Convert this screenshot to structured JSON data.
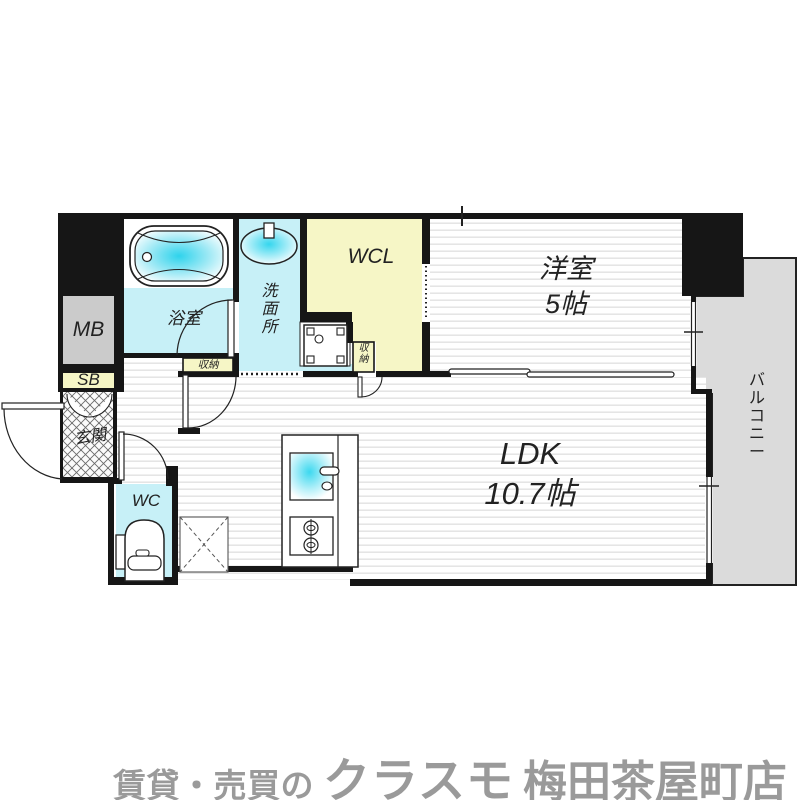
{
  "rooms": {
    "bathroom": "浴室",
    "washroom": "洗面所",
    "wcl": "WCL",
    "bedroom_name": "洋室",
    "bedroom_size": "5帖",
    "ldk_name": "LDK",
    "ldk_size": "10.7帖",
    "wc": "WC",
    "entrance": "玄関",
    "balcony": "バルコニー",
    "meter_box": "MB",
    "shaft_box": "SB",
    "storage_hall": "収納",
    "storage_wcl": "収納"
  },
  "footer": {
    "prefix": "賃貸・売買の",
    "brand": "クラスモ",
    "branch": "梅田茶屋町店"
  },
  "colors": {
    "wall": "#161616",
    "water_room": "#c7f0f7",
    "water_deep": "#2ed3ec",
    "closet_yellow": "#f6f6c6",
    "meter_gray": "#cbcbcb",
    "balcony_gray": "#dbdbdb",
    "stripe": "#e4e4e4",
    "logo_gray": "#9a9a9a",
    "label_ink": "#222222"
  }
}
